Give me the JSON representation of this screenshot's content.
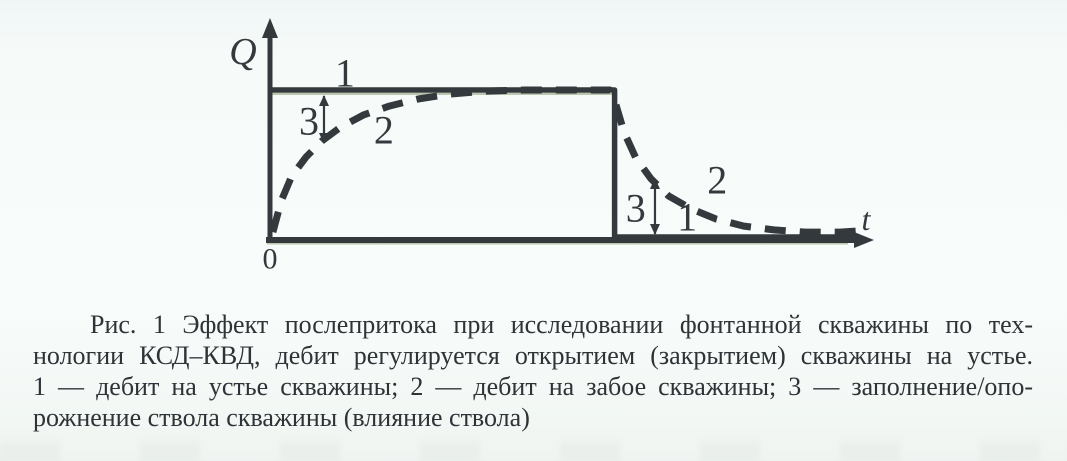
{
  "colors": {
    "ink": "#34393d",
    "text": "#2e3337",
    "paper": "#f6fbf9",
    "fringe": "#7d9164"
  },
  "chart_data": {
    "type": "line",
    "title": "Рис. 1 Эффект послепритока при исследовании фонтанной скважины по технологии КСД–КВД",
    "xlabel": "t",
    "ylabel": "Q",
    "origin_label": "0",
    "grid": false,
    "axes_qualitative": true,
    "x_range_norm": [
      0,
      1
    ],
    "y_range_norm": [
      0,
      1.15
    ],
    "step_time_norm": 0.584,
    "series": [
      {
        "label": "1",
        "name": "дебит на устье скважины",
        "style": "solid",
        "points": [
          [
            0.003,
            1
          ],
          [
            0.584,
            1
          ],
          [
            0.584,
            0.02
          ],
          [
            0.995,
            0.02
          ]
        ]
      },
      {
        "label": "2",
        "name": "дебит на забое скважины",
        "style": "dashed",
        "points": [
          [
            0.005,
            0.053
          ],
          [
            0.019,
            0.26
          ],
          [
            0.037,
            0.427
          ],
          [
            0.061,
            0.553
          ],
          [
            0.088,
            0.66
          ],
          [
            0.12,
            0.753
          ],
          [
            0.158,
            0.833
          ],
          [
            0.202,
            0.893
          ],
          [
            0.251,
            0.94
          ],
          [
            0.305,
            0.973
          ],
          [
            0.364,
            0.993
          ],
          [
            0.432,
            1.0
          ],
          [
            0.508,
            1.0
          ],
          [
            0.576,
            1.0
          ],
          [
            0.586,
            0.907
          ],
          [
            0.6,
            0.72
          ],
          [
            0.62,
            0.547
          ],
          [
            0.646,
            0.407
          ],
          [
            0.676,
            0.293
          ],
          [
            0.714,
            0.207
          ],
          [
            0.756,
            0.14
          ],
          [
            0.803,
            0.093
          ],
          [
            0.854,
            0.067
          ],
          [
            0.908,
            0.053
          ],
          [
            0.966,
            0.053
          ],
          [
            0.997,
            0.06
          ]
        ]
      }
    ],
    "annotations": [
      {
        "text": "1",
        "u": 0.127,
        "v": 1.113
      },
      {
        "text": "3",
        "u": 0.066,
        "v": 0.793
      },
      {
        "text": "2",
        "u": 0.193,
        "v": 0.733
      },
      {
        "text": "3",
        "u": 0.62,
        "v": 0.213
      },
      {
        "text": "1",
        "u": 0.707,
        "v": 0.153
      },
      {
        "text": "2",
        "u": 0.758,
        "v": 0.4
      }
    ],
    "gap_arrows": [
      {
        "u": 0.0915,
        "v1": 0.96,
        "v2": 0.647,
        "meaning": "заполнение ствола скважины"
      },
      {
        "u": 0.6525,
        "v1": 0.407,
        "v2": 0.04,
        "meaning": "опорожнение ствола скважины"
      }
    ]
  },
  "caption": {
    "lines": [
      "Рис. 1  Эффект послепритока при исследовании фонтанной скважины по тех-",
      "нологии КСД–КВД, дебит регулируется открытием (закрытием) скважины на устье.",
      "1 — дебит на устье скважины; 2 — дебит на забое скважины; 3 — заполнение/опо-",
      "рожнение ствола скважины (влияние ствола)"
    ]
  }
}
